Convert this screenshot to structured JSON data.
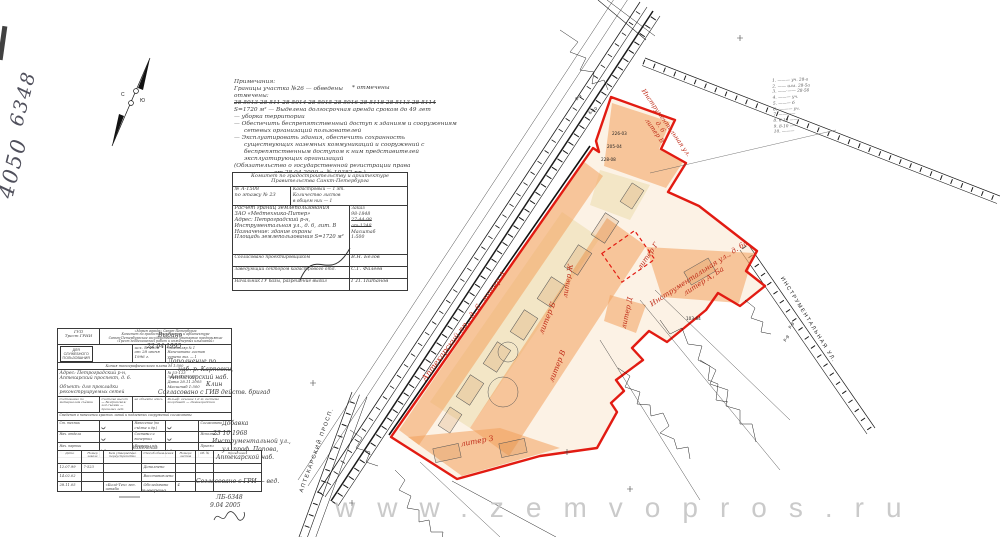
{
  "watermark": "www.zemvopros.ru",
  "margin_numbers": {
    "a": "4050",
    "b": "6348"
  },
  "compass": {
    "n": "С",
    "s": "Ю"
  },
  "top_notes": {
    "title": "Примечания:",
    "l2": "Границы участка №26 — обведены",
    "l2b": "* отмечены",
    "l3": "отмечены:",
    "struck": "28-5013   28-511   28-5014   28-5015   28-5016   28-5118   28-5113   28-5114",
    "l5": "S=1720 м² — Выделена долгосрочная аренда сроком до 49 лет",
    "l6": "— уборка территории",
    "l7": "— Обеспечить беспрепятственный доступ к зданиям и сооружениям",
    "l8": "сетевых организаций пользователей",
    "l9": "— Эксплуатировать здания, обеспечить сохранность",
    "l10": "существующих наземных коммуникаций и сооружений с",
    "l11": "беспрепятственным доступом к ним представителей",
    "l12": "эксплуатирующих организаций",
    "l13": "(Обязательство о государственной регистрации права",
    "l14": "от 28.04.2000 г.   № 10382 пр.)"
  },
  "side_list": {
    "items": [
      "1.  ——— уч. 28-а",
      "2.  —— илл. 28-5а",
      "3.  ——·—— 28-5б",
      "4.  ——— уч.",
      "5.  ——— б",
      "6.  ·——— уч.",
      "7.  ————",
      "8.  6-10 ——",
      "9.  8-10 ——",
      "10. ———"
    ]
  },
  "kga": {
    "header1": "Комитет по градостроительству и архитектуре",
    "header2": "Правительства Санкт-Петербурга",
    "num": "№ А-1508",
    "num2": "по этажу № 23",
    "kad1": "Кадастровый — 1 эт.",
    "kad2": "Количество листов",
    "kad3": "в общем них — 1",
    "body0": "Расчет границ землепользования",
    "body1": "ЗАО «Медтехника-Питер»",
    "body2": "Адрес: Петроградский р-н,",
    "body3": "Инструментальная ул., д. 6, лит. В",
    "body4": "Назначение: здание охраны",
    "body5": "Площадь землепользования S=1720 м²",
    "order_label": "Заказ",
    "order_no": "98-1848",
    "struck1": "27-44-98",
    "struck2": "ат-1248",
    "scale_label": "Масштаб",
    "scale": "1:500",
    "sig1_role": "Согласовано проектировщиком",
    "sig1_name": "В.Н. Белов",
    "sig2_role": "Заведующий сектором кадастрового отд.",
    "sig2_name": "С.Г. Фалеев",
    "sig3_role": "Начальник ГУ базы, разрешение выдал",
    "sig3_name": "Г.П. Питанов"
  },
  "grii": {
    "org_short1": "ГУП",
    "org_short2": "Трест ГРИИ",
    "org_lines": [
      "«Мэрия города» Санкт-Петербурга",
      "Комитет по градостроительству и архитектуре",
      "Санкт-Петербургское государственное унитарное предприятие",
      "«Трест геодезических работ и инженерных изысканий»"
    ],
    "dsp": [
      "ДЛЯ",
      "СЛУЖЕБНОГО",
      "ПОЛЬЗОВАНИЯ"
    ],
    "out_no": "исх. № 4596",
    "out_date": "от 28 июня 1996 г.",
    "copies": [
      "Экземпляр № 1",
      "Напечатано листов",
      "учтено экз. — 1"
    ],
    "copy_title": "Копия топографического плана   М 1:500",
    "addr1": "Адрес:  Петроградский р-н,",
    "addr2": "Аптекарский проспект, д. 6.",
    "purpose": "Объект: для прокладки реконструируемых сетей",
    "ref_no": "№ 53-123",
    "order": "Заказ 4777-05",
    "date": "Дата 28.11.2005",
    "scale": "Масштаб 1:500",
    "meta": [
      "Составлено по материалам съёмки",
      "Система высот — Балтийская; год съёмки — прошлых лет",
      "на объекте здесь",
      "Рельеф: сечение 1,0 м; система координат — Ленинградская"
    ],
    "redlines": "Сведения о нанесении красных линий и подземных сооружений согласованы",
    "sig_rows": [
      [
        "Ст. техник",
        "Нанесение (по съёмке и др.)",
        "Согласовано"
      ],
      [
        "Нач. отдела",
        "Составил и вычертил",
        "Исполнил"
      ],
      [
        "Нач. партии",
        "Проверил п/п",
        "Принял"
      ],
      [
        "Нач. ОТК",
        "Корректура",
        "Выпустил"
      ]
    ]
  },
  "changes": {
    "title": "Изменения",
    "headers": [
      "Дата",
      "Номер заказа",
      "Кем утверждено переустройство",
      "Способ обновления",
      "Номера листов",
      "Об. №",
      "Примечания"
    ],
    "rows": [
      [
        "12.07.99",
        "7-523",
        "",
        "Дополнено",
        "",
        "",
        ""
      ],
      [
        "14.02.02",
        "",
        "",
        "Восстановлено",
        "",
        "",
        ""
      ],
      [
        "28.11.05",
        "",
        "«Билд-Тех» ген. штаба",
        "Обследовано",
        "4",
        "",
        ""
      ]
    ]
  },
  "hand_notes": {
    "issue": "Выдано",
    "issue_date": "22   04   1995",
    "n1": "Дополнение по",
    "n2": "наб. р. Карповки,",
    "n3": "Аптекарский наб.",
    "n4": "Клин",
    "agree1": "Согласовано с ГИВ действ. бригад",
    "add": "Добавка",
    "add_date": "23   10   1968",
    "street0": "Инструментальной ул.,",
    "street1": "ул. проф. Попова,",
    "street2": "Аптекарской наб.",
    "agree2": "Согласовано с ГРИ — вед.",
    "ref": "ЛБ-6348",
    "ref_date": "9.04       2005",
    "check": "выверено"
  },
  "map": {
    "street_instrumental": "ИНСТРУМЕНТАЛЬНАЯ  УЛ.",
    "street_aptekarsky": "АПТЕКАРСКИЙ  ПРОСП.",
    "lbl_apt_a": "Аптекарский пр., д. 6, литер А",
    "lbl_b": "литер Б",
    "lbl_zh": "литер Ж",
    "lbl_v": "литер В",
    "lbl_g": "литер Г",
    "lbl_d": "литер Д",
    "lbl_z": "литер З",
    "lbl_instr1": "Инструментальная ул., д. 6а",
    "lbl_instr2": "литер А, Ба",
    "lbl_top1": "Инструментальная ул.",
    "lbl_top2": "д. 6",
    "lbl_top3": "литер В",
    "micro": [
      "6-9",
      "Б-10",
      "226-03",
      "205-04",
      "228-08",
      "Р-9",
      "Р-9",
      "103-64"
    ]
  },
  "colors": {
    "boundary": "#e21b12",
    "fill_orange": "#f2a05c",
    "fill_cream": "#ead9a8",
    "label_red": "#bf2b18",
    "watermark": "#c5c5c5"
  }
}
